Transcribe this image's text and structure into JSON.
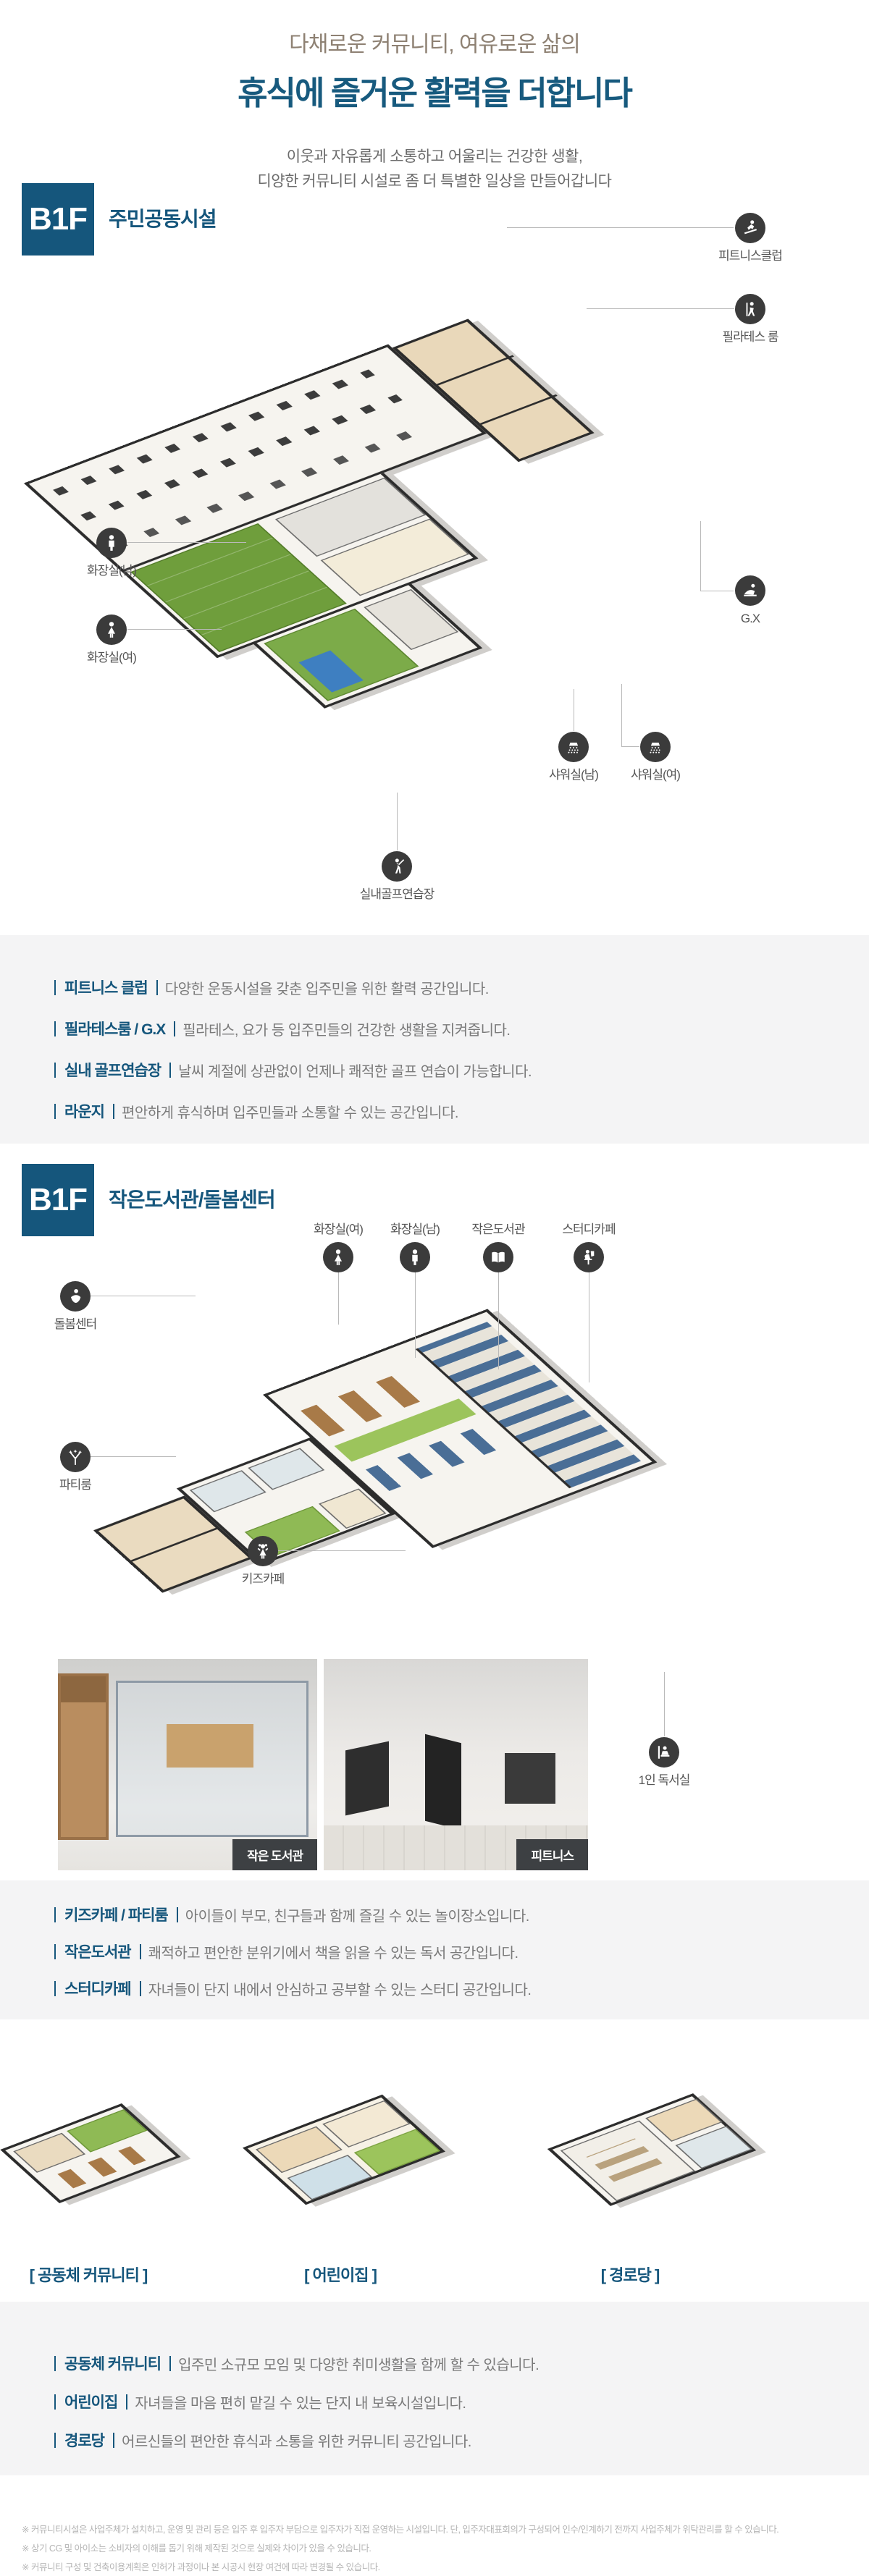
{
  "header": {
    "subtitle": "다채로운 커뮤니티, 여유로운 삶의",
    "title": "휴식에 즐거운 활력을 더합니다",
    "desc_line1": "이웃과 자유롭게 소통하고 어울리는 건강한 생활,",
    "desc_line2": "디양한 커뮤니티 시설로 좀 더 특별한 일상을 만들어갑니다"
  },
  "colors": {
    "accent_blue": "#15567c",
    "subtitle_taupe": "#8e8173",
    "callout_circle": "#3b3b3b",
    "desc_box_bg": "#f4f4f5",
    "photo_badge_bg": "#3d4043",
    "golf_green": "#6f9e3c",
    "note_gray": "#b5b5b5"
  },
  "section1": {
    "floor": "B1F",
    "title": "주민공동시설",
    "callouts": [
      {
        "label": "피트니스클럽",
        "icon": "treadmill-runner-icon"
      },
      {
        "label": "필라테스 룸",
        "icon": "pilates-icon"
      },
      {
        "label": "화장실(남)",
        "icon": "male-icon"
      },
      {
        "label": "화장실(여)",
        "icon": "female-icon"
      },
      {
        "label": "G.X",
        "icon": "yoga-icon"
      },
      {
        "label": "샤워실(남)",
        "icon": "shower-icon"
      },
      {
        "label": "샤워실(여)",
        "icon": "shower-icon"
      },
      {
        "label": "실내골프연습장",
        "icon": "golfer-icon"
      }
    ],
    "descriptions": [
      {
        "term": "피트니스 클럽",
        "text": "다양한 운동시설을 갖춘 입주민을 위한 활력 공간입니다."
      },
      {
        "term": "필라테스룸 / G.X",
        "text": "필라테스, 요가 등 입주민들의 건강한 생활을 지켜줍니다."
      },
      {
        "term": "실내 골프연습장",
        "text": "날씨 계절에 상관없이 언제나 쾌적한 골프 연습이 가능합니다."
      },
      {
        "term": "라운지",
        "text": "편안하게 휴식하며 입주민들과 소통할 수 있는 공간입니다."
      }
    ]
  },
  "section2": {
    "floor": "B1F",
    "title": "작은도서관/돌봄센터",
    "callouts": [
      {
        "label": "화장실(여)",
        "icon": "female-icon"
      },
      {
        "label": "화장실(남)",
        "icon": "male-icon"
      },
      {
        "label": "작은도서관",
        "icon": "open-book-icon"
      },
      {
        "label": "스터디카페",
        "icon": "study-desk-icon"
      },
      {
        "label": "돌봄센터",
        "icon": "baby-care-icon"
      },
      {
        "label": "파티룸",
        "icon": "fireworks-icon"
      },
      {
        "label": "키즈카페",
        "icon": "kid-icon"
      },
      {
        "label": "1인 독서실",
        "icon": "reading-carrel-icon"
      }
    ],
    "photos": [
      {
        "badge": "작은 도서관"
      },
      {
        "badge": "피트니스"
      }
    ],
    "descriptions": [
      {
        "term": "키즈카페 / 파티룸",
        "text": "아이들이 부모, 친구들과 함께 즐길 수 있는 놀이장소입니다."
      },
      {
        "term": "작은도서관",
        "text": "쾌적하고 편안한 분위기에서 책을 읽을 수 있는 독서 공간입니다."
      },
      {
        "term": "스터디카페",
        "text": "자녀들이 단지 내에서 안심하고 공부할 수 있는 스터디 공간입니다."
      }
    ]
  },
  "section3": {
    "plans": [
      {
        "label": "[ 공동체 커뮤니티 ]"
      },
      {
        "label": "[ 어린이집 ]"
      },
      {
        "label": "[ 경로당 ]"
      }
    ],
    "descriptions": [
      {
        "term": "공동체 커뮤니티",
        "text": "입주민 소규모 모임 및 다양한 취미생활을 함께 할 수 있습니다."
      },
      {
        "term": "어린이집",
        "text": "자녀들을 마음 편히 맡길 수 있는 단지 내 보육시설입니다."
      },
      {
        "term": "경로당",
        "text": "어르신들의 편안한 휴식과 소통을 위한 커뮤니티 공간입니다."
      }
    ]
  },
  "footer": {
    "notes": [
      "※ 커뮤니티시설은 사업주체가 설치하고, 운영 및 관리 등은 입주 후 입주자 부담으로 입주자가 직접 운영하는 시설입니다. 단, 입주자대표회의가 구성되어 인수/인계하기 전까지 사업주체가 위탁관리를 할 수 있습니다.",
      "※ 상기 CG 및 아이소는 소비자의 이해를 돕기 위해 제작된 것으로 실제와 차이가 있을 수 있습니다.",
      "※ 커뮤니티 구성 및 건축이용계획은 인허가 과정이나 본 시공시 현장 여건에 따라 변경될 수 있습니다.",
      "※ 커뮤니티 시설은 의무화된 품목만 당사가 시공하므로 제공 집기 및 마감재는 변동될 수 있으며, 시설물의 위치, 규모, 기구, 운동기구 등은 실제 시공시 변경될 수 있습니다."
    ]
  }
}
